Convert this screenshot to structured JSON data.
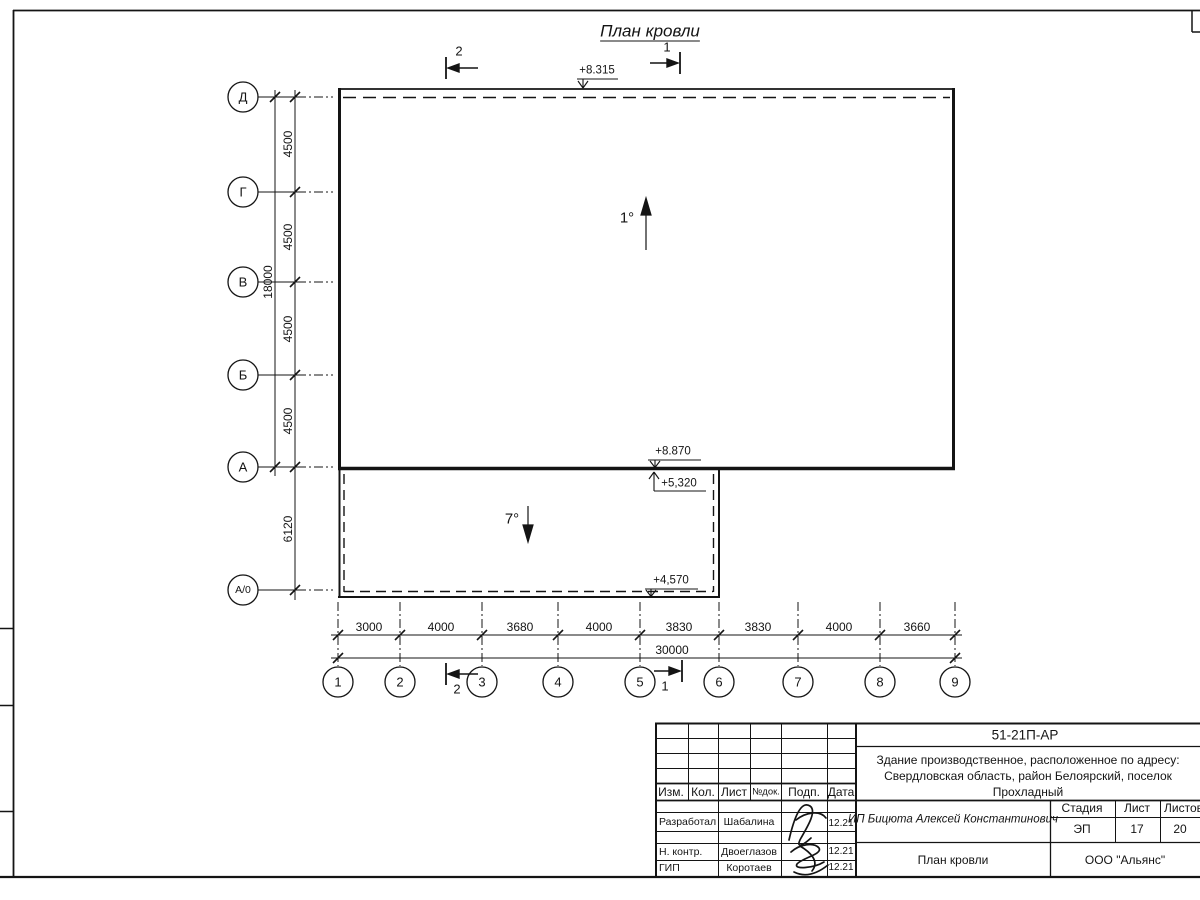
{
  "drawing": {
    "title": "План кровли",
    "slopes": {
      "main": "1°",
      "annex": "7°"
    },
    "elevations": {
      "roof_top": "+8.315",
      "wall_a_top": "+8.870",
      "wall_a_bottom": "+5,320",
      "annex_edge": "+4,570"
    },
    "section_marks": {
      "mark1": "1",
      "mark2": "2"
    },
    "axes": {
      "rows": [
        "Д",
        "Г",
        "В",
        "Б",
        "А",
        "А/0"
      ],
      "cols": [
        "1",
        "2",
        "3",
        "4",
        "5",
        "6",
        "7",
        "8",
        "9"
      ],
      "row_spans": [
        "4500",
        "4500",
        "4500",
        "4500",
        "6120"
      ],
      "row_total": "18000",
      "col_spans": [
        "3000",
        "4000",
        "3680",
        "4000",
        "3830",
        "3830",
        "4000",
        "3660"
      ],
      "col_total": "30000"
    }
  },
  "titleblock": {
    "doc_number": "51-21П-АР",
    "object_line1": "Здание производственное, расположенное по адресу:",
    "object_line2": "Свердловская область, район Белоярский, поселок",
    "object_line3": "Прохладный",
    "header": {
      "izm": "Изм.",
      "kol": "Кол.",
      "list": "Лист",
      "ndoc": "№док.",
      "podp": "Подп.",
      "data": "Дата"
    },
    "rows": [
      {
        "role": "Разработал",
        "name": "Шабалина",
        "date": "12.21"
      },
      {
        "role": "Н. контр.",
        "name": "Двоеглазов",
        "date": "12.21"
      },
      {
        "role": "ГИП",
        "name": "Коротаев",
        "date": "12.21"
      }
    ],
    "customer": "ИП Бицюта Алексей Константинович",
    "stage_label": "Стадия",
    "sheet_label": "Лист",
    "sheets_label": "Листов",
    "stage": "ЭП",
    "sheet": "17",
    "sheets": "20",
    "sheet_title": "План кровли",
    "company": "ООО \"Альянс\""
  }
}
